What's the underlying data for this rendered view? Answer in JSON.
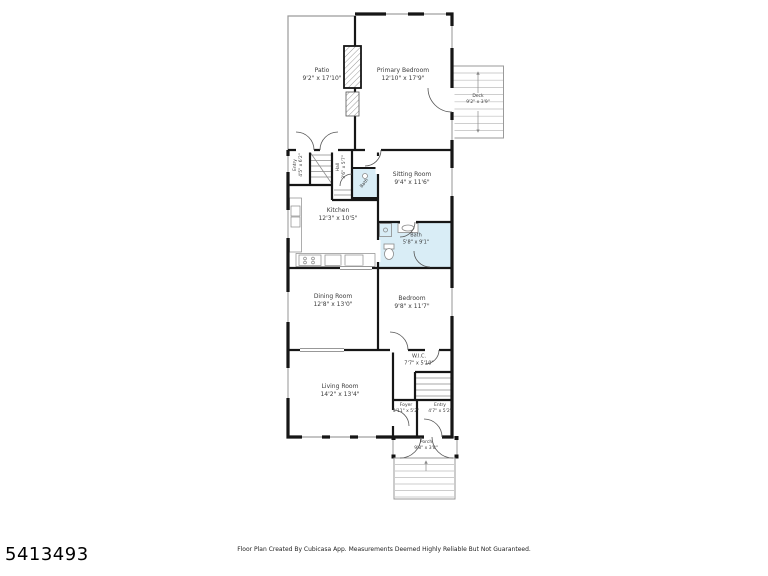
{
  "listing_number": "5413493",
  "footer": {
    "disclaimer": "Floor Plan Created By Cubicasa App. Measurements Deemed Highly Reliable But Not Guaranteed."
  },
  "floor_plan": {
    "colors": {
      "wall": "#161616",
      "bath_fill": "#d9edf6",
      "thin_line": "#9a9a9a"
    },
    "rooms": {
      "patio": {
        "name": "Patio",
        "dims": "9'2\" x 17'10\""
      },
      "primary_bedroom": {
        "name": "Primary Bedroom",
        "dims": "12'10\" x 17'9\""
      },
      "deck": {
        "name": "Deck",
        "dims": "9'2\" x 3'9\""
      },
      "back_entry": {
        "name": "Entry",
        "dims": "4'5\" x 6'2\""
      },
      "hall": {
        "name": "Hall",
        "dims": "3'6\" x 5'7\""
      },
      "half_bath": {
        "name": "Bath",
        "dims": ""
      },
      "sitting_room": {
        "name": "Sitting Room",
        "dims": "9'4\" x 11'6\""
      },
      "kitchen": {
        "name": "Kitchen",
        "dims": "12'3\" x 10'5\""
      },
      "bath": {
        "name": "Bath",
        "dims": "5'8\" x 9'1\""
      },
      "dining_room": {
        "name": "Dining Room",
        "dims": "12'8\" x 13'0\""
      },
      "bedroom": {
        "name": "Bedroom",
        "dims": "9'8\" x 11'7\""
      },
      "wic": {
        "name": "W.I.C.",
        "dims": "7'7\" x 5'10\""
      },
      "living_room": {
        "name": "Living Room",
        "dims": "14'2\" x 13'4\""
      },
      "foyer": {
        "name": "Foyer",
        "dims": "3'11\" x 5'2\""
      },
      "entry": {
        "name": "Entry",
        "dims": "4'7\" x 5'2\""
      },
      "porch": {
        "name": "Porch",
        "dims": "9'8\" x 3'8\""
      }
    }
  }
}
